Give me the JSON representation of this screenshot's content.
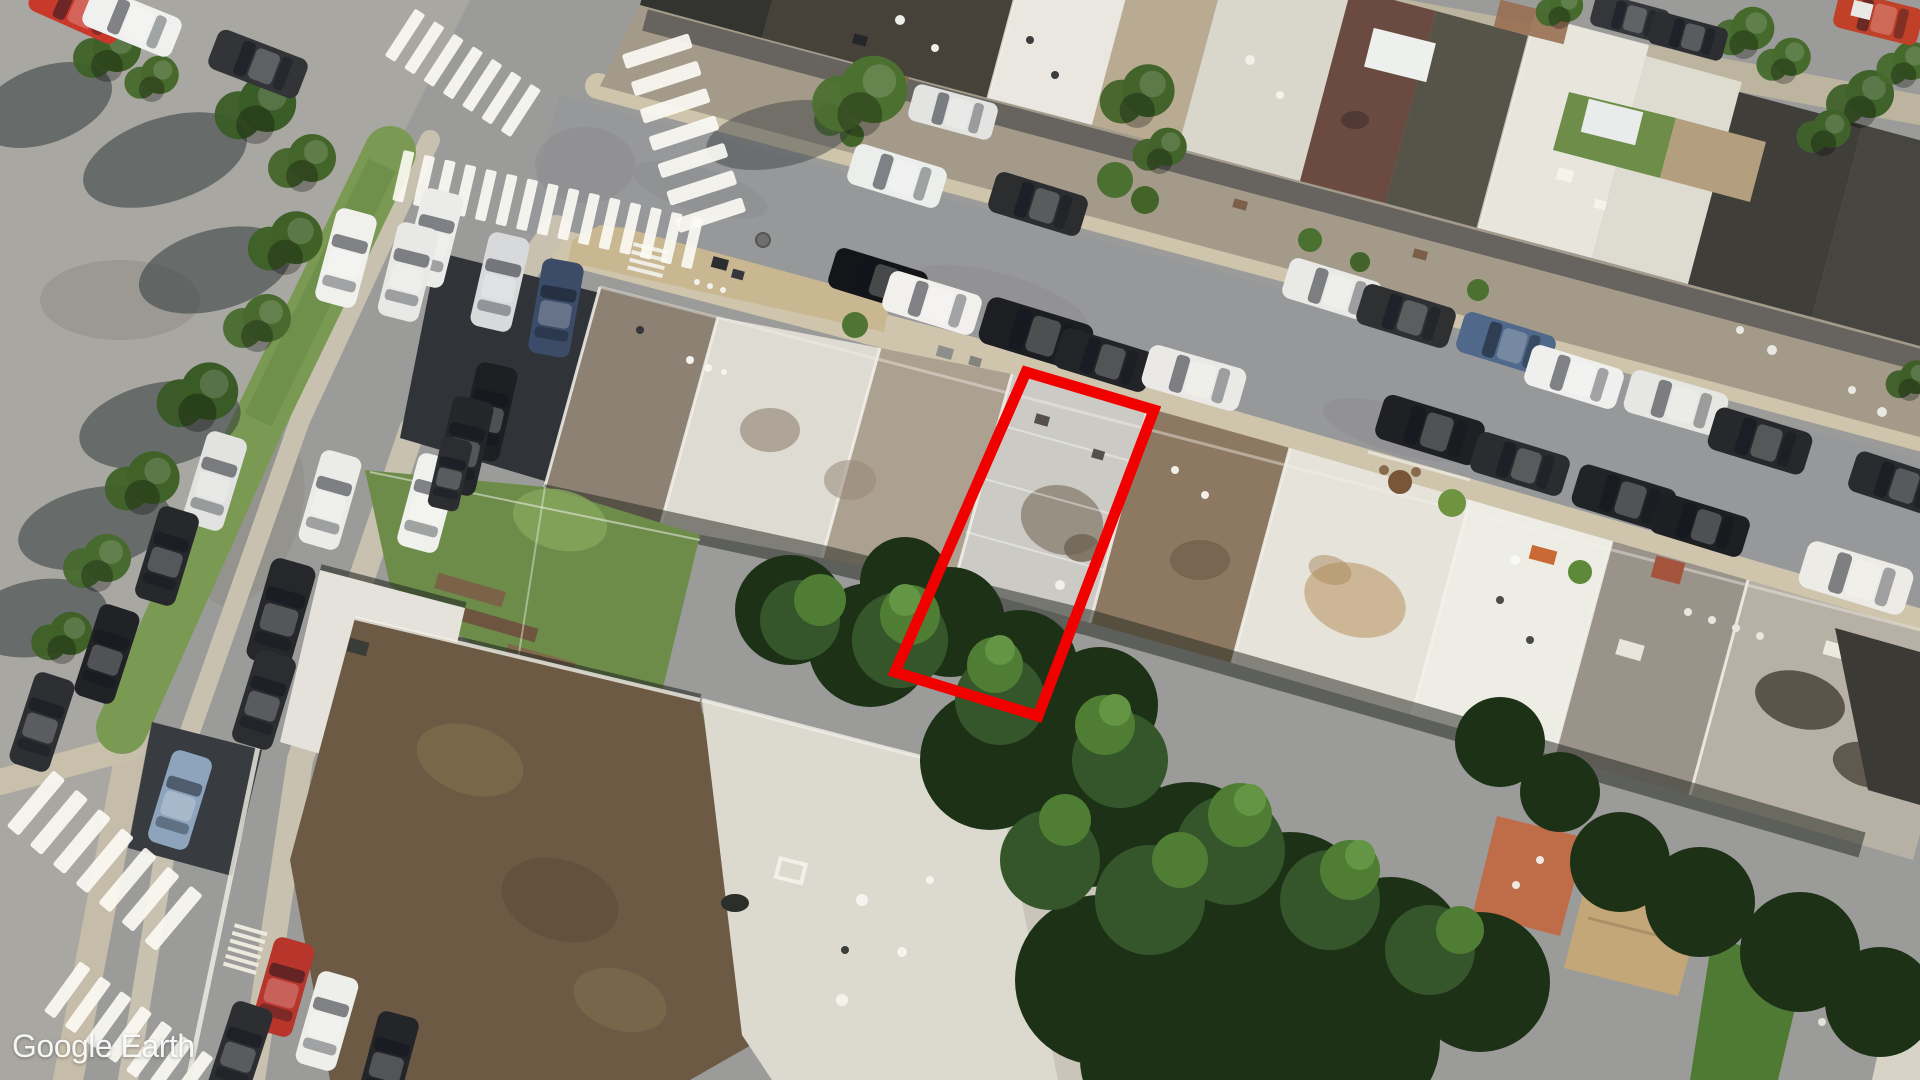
{
  "watermark": {
    "text": "Google Earth"
  },
  "annotation": {
    "label": "highlighted-property-outline",
    "color": "#f10000",
    "stroke_width": 11,
    "points": "1026,372 1154,410 1038,716 895,672"
  }
}
